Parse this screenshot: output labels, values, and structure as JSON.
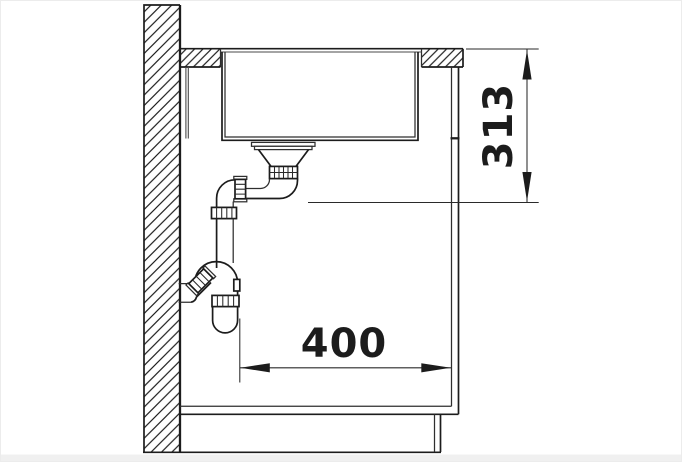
{
  "drawing": {
    "kind": "sink-installation-side-section",
    "dimensions": {
      "vertical": {
        "label": "313",
        "orientation": "vertical"
      },
      "horizontal": {
        "label": "400",
        "orientation": "horizontal"
      }
    },
    "parts": [
      "wall",
      "countertop",
      "sink-bowl",
      "strainer-drain",
      "drain-elbow",
      "siphon-trap",
      "wall-outlet-pipe",
      "cabinet-back-panel",
      "cabinet-side-panel",
      "cabinet-bottom-panel",
      "plinth",
      "floor-line"
    ],
    "colors": {
      "line": "#1c1c1c",
      "background": "#ffffff",
      "strip": "#f0f0f0"
    }
  }
}
